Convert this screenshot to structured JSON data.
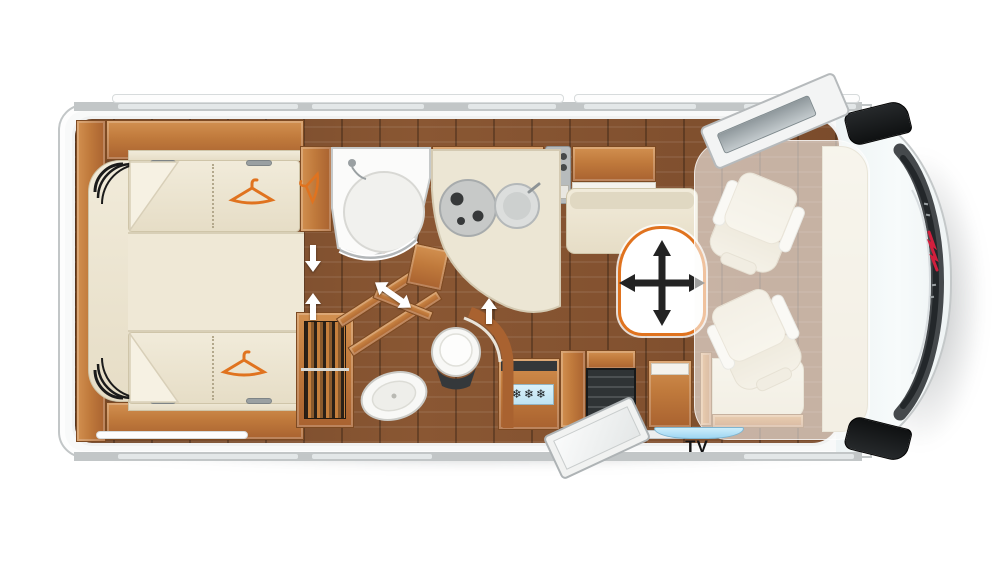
{
  "meta": {
    "description": "Top-view floor plan of an A-class motorhome, rear at left and driver cab at right",
    "canvas": {
      "width": 1000,
      "height": 563
    }
  },
  "labels": {
    "tv": "TV"
  },
  "fridge": {
    "freezer_icon": "❄❄❄"
  },
  "icons": [
    {
      "name": "wardrobe-hanger-icon",
      "shape": "clothes hanger outline",
      "color": "#e0731f"
    },
    {
      "name": "movable-table-icon",
      "shape": "four-way arrow cross",
      "color": "#232323"
    },
    {
      "name": "walkway-arrow-icon",
      "shape": "white block arrow",
      "color": "#ffffff"
    },
    {
      "name": "freezer-icon",
      "shape": "three snowflakes on blue panel",
      "color": "#15181a"
    },
    {
      "name": "brand-mark",
      "shape": "small red script mark on windshield pillar",
      "color": "#d11f3d"
    }
  ],
  "colors": {
    "accent_orange": "#e0731f",
    "body_gray": "#c2c6c7",
    "wood_cabinet": "#c07a3c",
    "floor_brown": "#7b4c2c",
    "upholstery_cream": "#ece5d3",
    "fixture_white": "#f7f7f5",
    "door_window_blue": "#a8dcf3",
    "step_well_dark": "#2f3335",
    "windshield_dark": "#45494c",
    "brand_red": "#d11f3d"
  }
}
